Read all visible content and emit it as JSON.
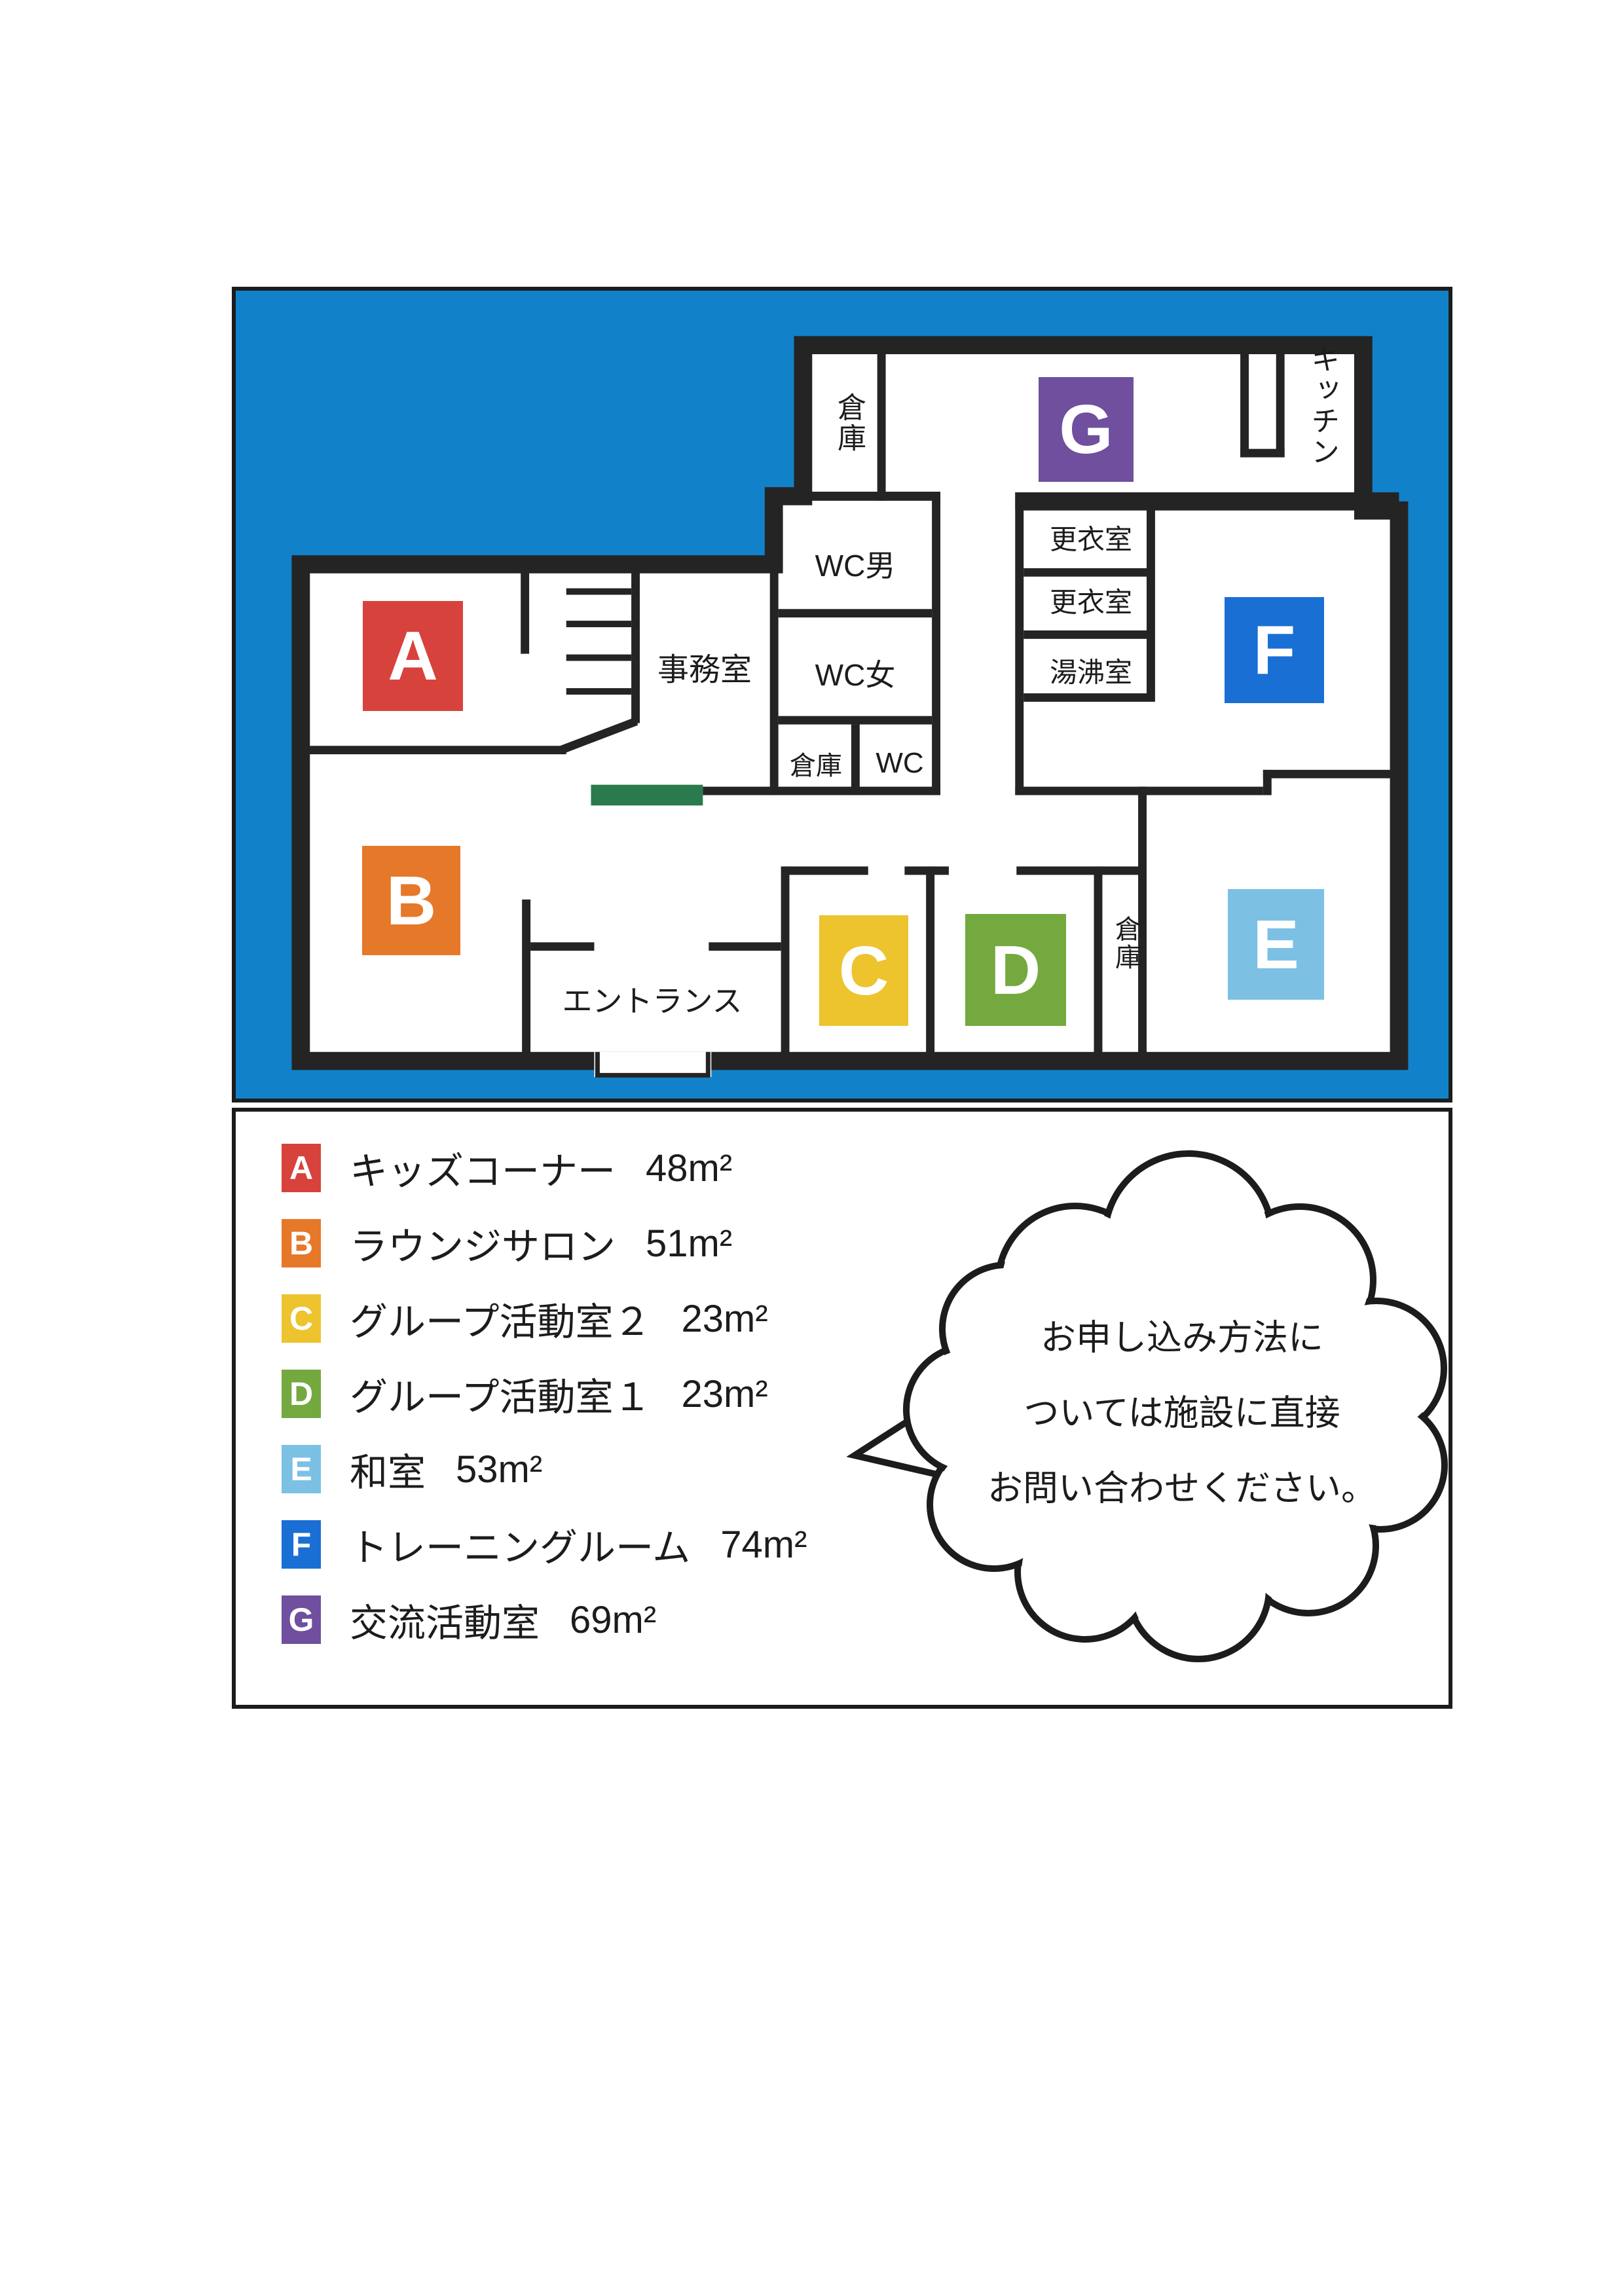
{
  "colors": {
    "panel_blue": "#1182ca",
    "wall": "#242424",
    "counter_green": "#2a7a4e"
  },
  "plan": {
    "markers": {
      "A": {
        "letter": "A",
        "color": "#d8423c"
      },
      "B": {
        "letter": "B",
        "color": "#e6782a"
      },
      "C": {
        "letter": "C",
        "color": "#edc32e"
      },
      "D": {
        "letter": "D",
        "color": "#74a93f"
      },
      "E": {
        "letter": "E",
        "color": "#7cc0e4"
      },
      "F": {
        "letter": "F",
        "color": "#1a6fd4"
      },
      "G": {
        "letter": "G",
        "color": "#6f4f9e"
      }
    },
    "labels": {
      "office": "事務室",
      "wc_men": "WC男",
      "wc_women": "WC女",
      "wc": "WC",
      "storage_north": "倉庫",
      "storage_center": "倉庫",
      "storage_east": "倉庫",
      "kitchen": "キッチン",
      "locker_room_1": "更衣室",
      "locker_room_2": "更衣室",
      "kettle_room": "湯沸室",
      "entrance": "エントランス"
    }
  },
  "legend": {
    "items": [
      {
        "letter": "A",
        "color": "#d8423c",
        "name": "キッズコーナー",
        "area": "48m²"
      },
      {
        "letter": "B",
        "color": "#e6782a",
        "name": "ラウンジサロン",
        "area": "51m²"
      },
      {
        "letter": "C",
        "color": "#edc32e",
        "name": "グループ活動室２",
        "area": "23m²"
      },
      {
        "letter": "D",
        "color": "#74a93f",
        "name": "グループ活動室１",
        "area": "23m²"
      },
      {
        "letter": "E",
        "color": "#7cc0e4",
        "name": "和室",
        "area": "53m²"
      },
      {
        "letter": "F",
        "color": "#1a6fd4",
        "name": "トレーニングルーム",
        "area": "74m²"
      },
      {
        "letter": "G",
        "color": "#6f4f9e",
        "name": "交流活動室",
        "area": "69m²"
      }
    ]
  },
  "callout": {
    "lines": [
      "お申し込み方法に",
      "ついては施設に直接",
      "お問い合わせください。"
    ]
  }
}
